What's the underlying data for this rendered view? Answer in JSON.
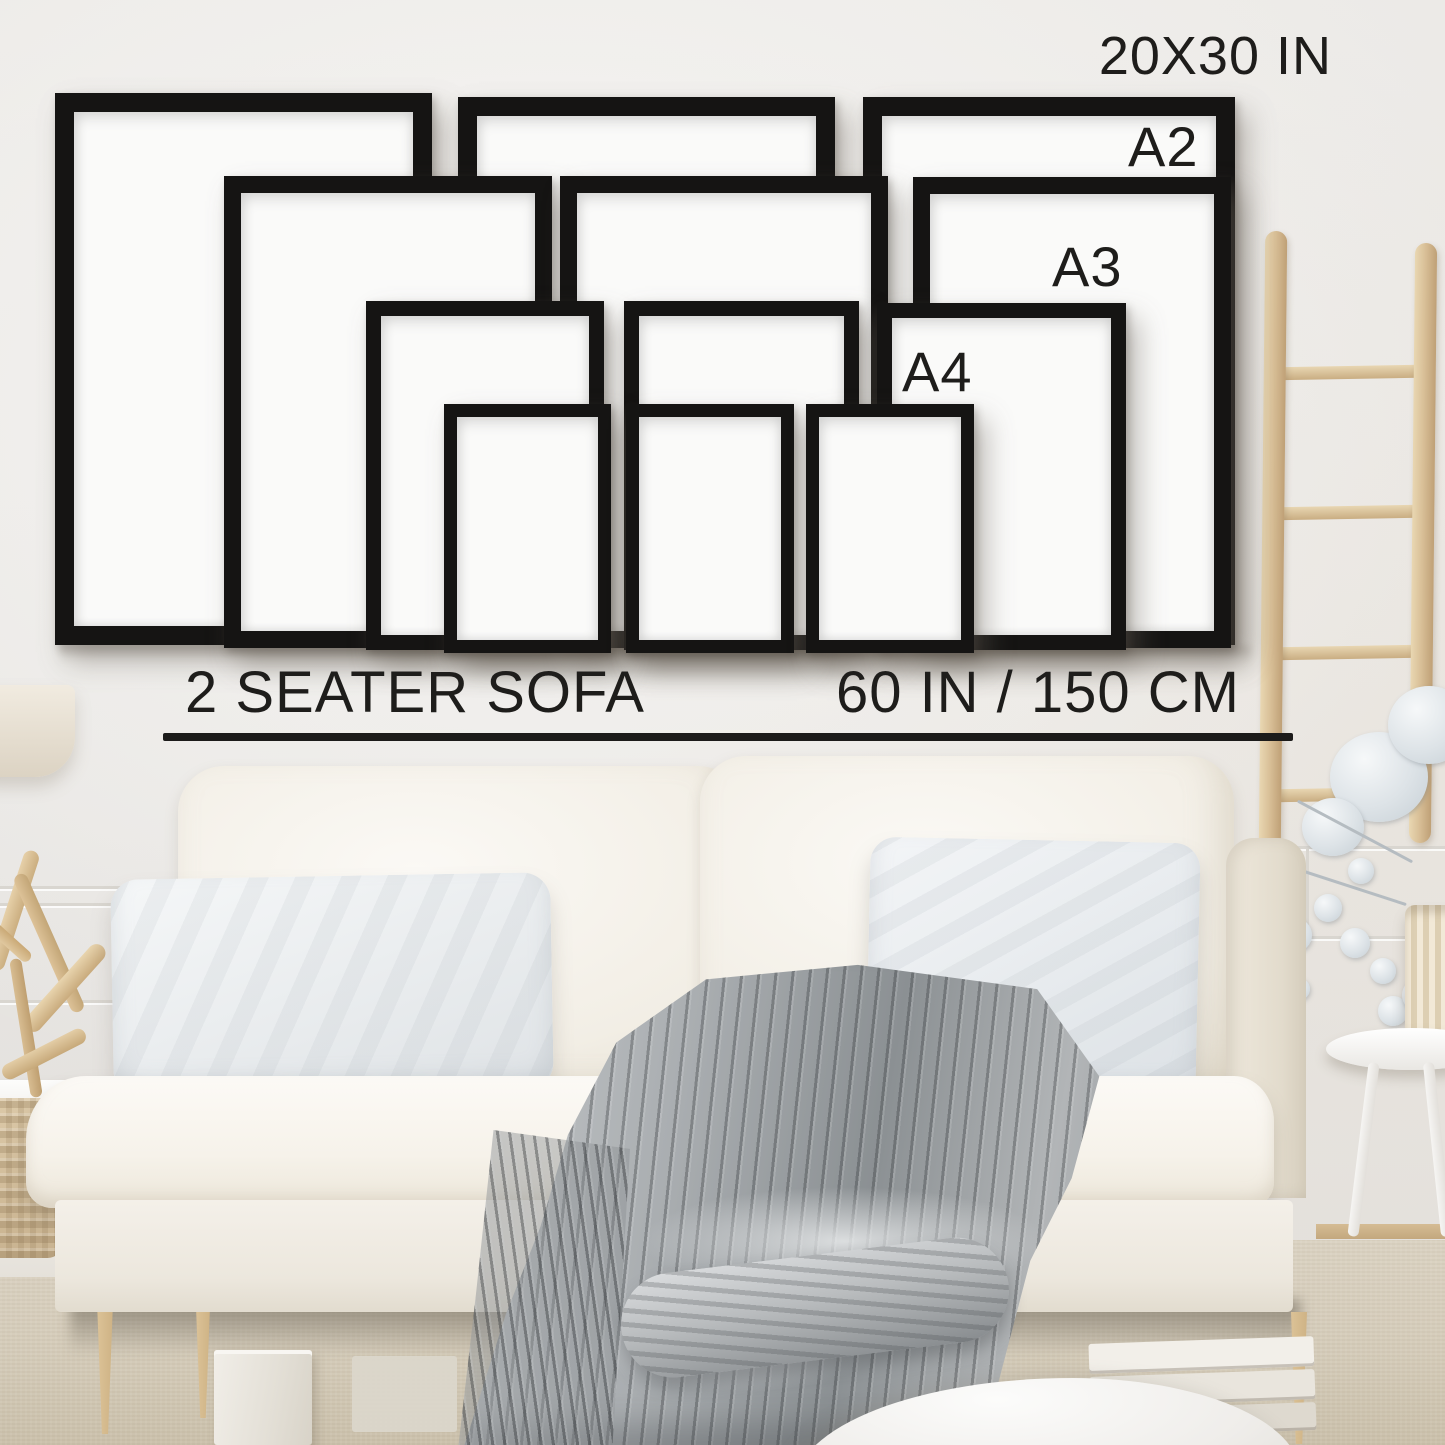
{
  "labels": {
    "size_20x30": "20X30 IN",
    "size_a2": "A2",
    "size_a3": "A3",
    "size_a4": "A4"
  },
  "caption": {
    "sofa": "2 SEATER SOFA",
    "width": "60 IN / 150 CM"
  },
  "palette": {
    "wall": "#e9e7e4",
    "text": "#1e1d1b",
    "frame_black": "#151413",
    "sofa_cream": "#f5f1e9",
    "pillow_gray": "#e9edf0",
    "blanket_gray": "#a6aaae",
    "wood_light": "#dcc49c",
    "floor_beige": "#d7cfbf"
  },
  "scene_objects": [
    "frame-size-guide",
    "two-seater-sofa",
    "knit-throw-blanket",
    "scatter-cushions",
    "blanket-ladder",
    "dried-flower-arrangement",
    "round-side-table",
    "driftwood-decor",
    "table-lamp",
    "woven-basket",
    "storage-boxes",
    "floor-cushion"
  ]
}
